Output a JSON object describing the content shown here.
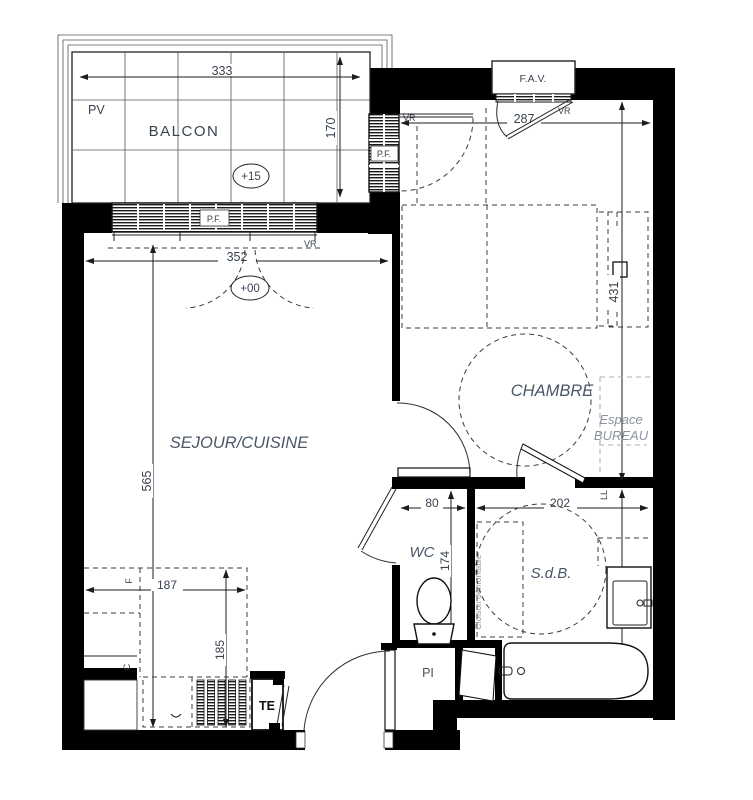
{
  "colors": {
    "wall": "#000000",
    "dim_text": "#39434f",
    "room_text": "#4b5766",
    "muted_text": "#8c939d",
    "background": "#ffffff"
  },
  "labels": {
    "pv": "PV",
    "balcon": "BALCON",
    "balcon_level": "+15",
    "sejour_level": "+00",
    "sejour": "SEJOUR/CUISINE",
    "chambre": "CHAMBRE",
    "bureau_line1": "Espace",
    "bureau_line2": "BUREAU",
    "wc": "WC",
    "sdb": "S.d.B.",
    "fav": "F.A.V.",
    "pf": "P.F.",
    "vr": "VR",
    "te": "TE",
    "pi": "PI",
    "ll": "LL",
    "fridge": "F",
    "cooker": "C",
    "cloison": "Cloison démontable"
  },
  "dims": {
    "balcon_w": "333",
    "balcon_d": "170",
    "sejour_w": "352",
    "sejour_h": "565",
    "kitchen_w": "187",
    "kitchen_h": "185",
    "chambre_w": "287",
    "chambre_h": "431",
    "wc_w": "80",
    "wc_h": "174",
    "sdb_w": "202",
    "sdb_h": "244"
  }
}
